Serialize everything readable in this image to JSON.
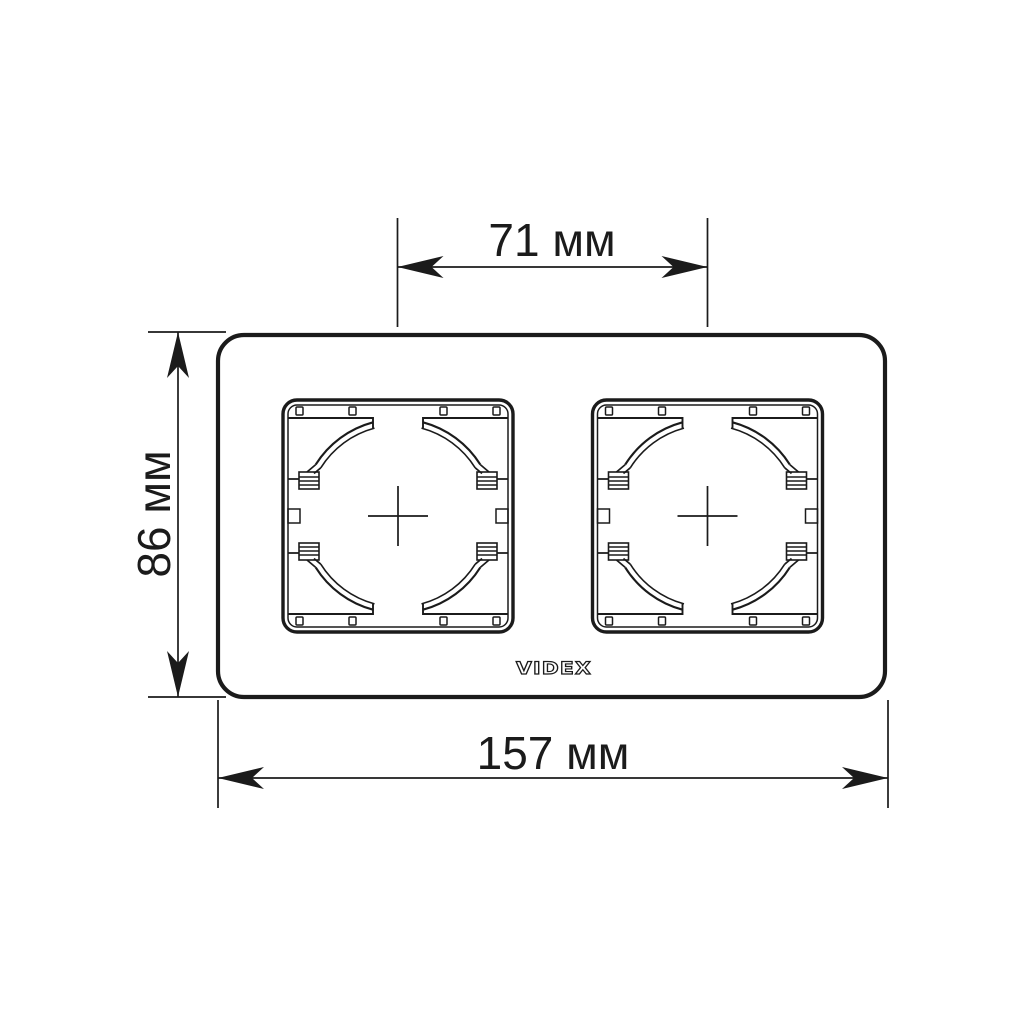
{
  "drawing": {
    "brand_logo": "VIDEX",
    "dimensions": {
      "socket_center_spacing": "71 мм",
      "frame_height": "86 мм",
      "frame_width": "157 мм"
    },
    "colors": {
      "line": "#1b1b1b",
      "background": "#ffffff"
    }
  }
}
